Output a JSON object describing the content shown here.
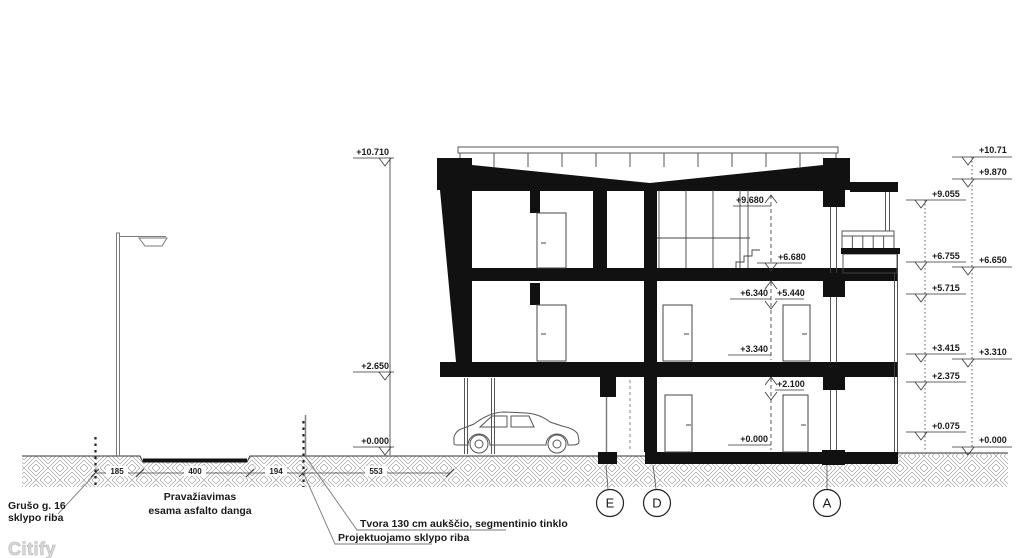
{
  "drawing": {
    "watermark": "Citify",
    "annotations": {
      "left_boundary_line1": "Grušo g. 16",
      "left_boundary_line2": "sklypo riba",
      "driveway_line1": "Pravažiavimas",
      "driveway_line2": "esama asfalto danga",
      "fence_note": "Tvora 130 cm aukščio, segmentinio tinklo",
      "proj_boundary_note": "Projektuojamo sklypo riba"
    },
    "ground_dims": [
      "185",
      "400",
      "194",
      "553"
    ],
    "levels_left": [
      "+10.710",
      "+2.650",
      "+0.000"
    ],
    "levels_right_outer": [
      "+10.71",
      "+9.870",
      "+6.650",
      "+3.310",
      "+0.000"
    ],
    "levels_right_inner": [
      "+9.055",
      "+6.755",
      "+5.715",
      "+3.415",
      "+2.375",
      "+0.075"
    ],
    "levels_interior": [
      "+9.680",
      "+6.680",
      "+6.340",
      "+5.440",
      "+3.340",
      "+2.100",
      "+0.000"
    ],
    "grid_axes": [
      "E",
      "D",
      "A"
    ],
    "colors": {
      "ink": "#111111",
      "hatch": "#9a9a9a",
      "gray": "#6b6b6b"
    }
  }
}
